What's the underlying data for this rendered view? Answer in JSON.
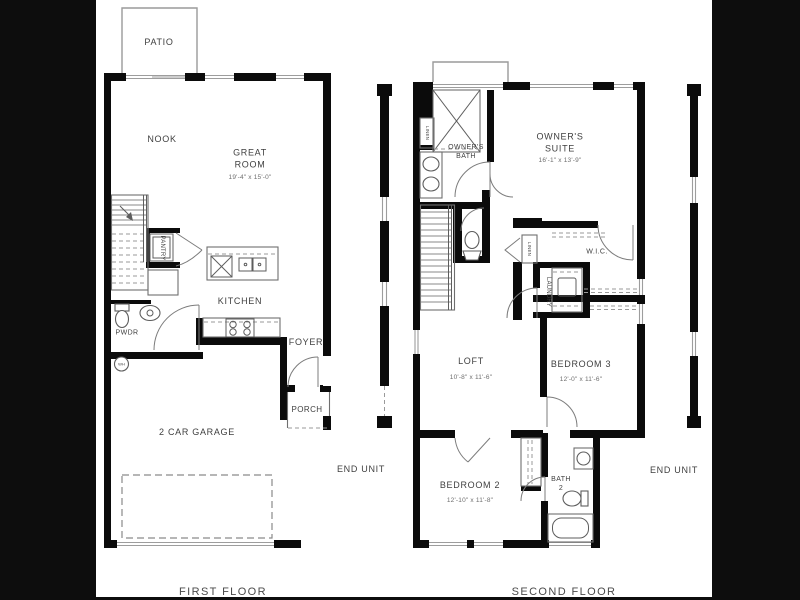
{
  "colors": {
    "letterbox": "#0d0d0d",
    "paper": "#ffffff",
    "wall": "#0b0b0b",
    "window_gray": "#9d9d9d",
    "label_text": "#3f3f3f",
    "dim_text": "#6e6e6e"
  },
  "first_floor": {
    "caption": "FIRST FLOOR",
    "end_unit_label": "END UNIT",
    "rooms": {
      "patio": {
        "name": "PATIO"
      },
      "nook": {
        "name": "NOOK"
      },
      "great_room": {
        "name": "GREAT ROOM",
        "dims": "19'-4\" x 15'-0\""
      },
      "pantry": {
        "name": "PANTRY"
      },
      "kitchen": {
        "name": "KITCHEN"
      },
      "powder": {
        "name": "PWDR"
      },
      "water_heater": {
        "name": "WH"
      },
      "foyer": {
        "name": "FOYER"
      },
      "porch": {
        "name": "PORCH"
      },
      "garage": {
        "name": "2 CAR GARAGE"
      }
    }
  },
  "second_floor": {
    "caption": "SECOND FLOOR",
    "end_unit_label": "END UNIT",
    "rooms": {
      "linen_bath": {
        "name": "LINEN"
      },
      "owners_bath": {
        "name": "OWNER'S BATH"
      },
      "owners_suite": {
        "name": "OWNER'S SUITE",
        "dims": "16'-1\" x 13'-9\""
      },
      "wic": {
        "name": "W.I.C."
      },
      "linen_hall": {
        "name": "LINEN"
      },
      "laundry": {
        "name": "LAUNDRY"
      },
      "loft": {
        "name": "LOFT",
        "dims": "10'-8\" x 11'-6\""
      },
      "bedroom3": {
        "name": "BEDROOM 3",
        "dims": "12'-0\" x 11'-6\""
      },
      "bedroom2": {
        "name": "BEDROOM 2",
        "dims": "12'-10\" x 11'-8\""
      },
      "bath2": {
        "name": "BATH 2"
      }
    }
  }
}
